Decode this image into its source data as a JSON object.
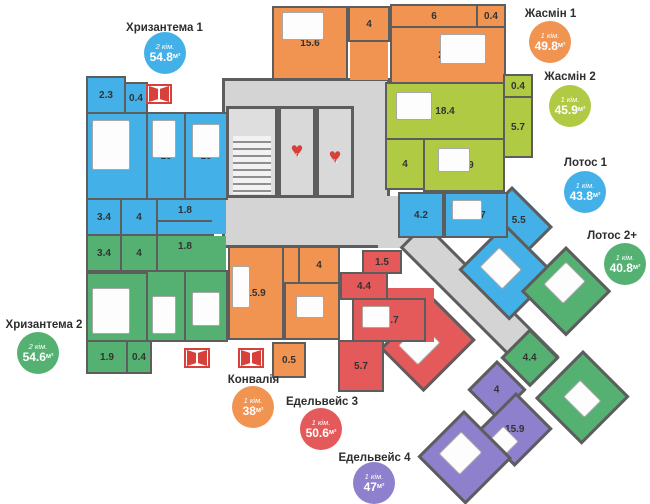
{
  "colors": {
    "blue": "#43b1e8",
    "green": "#54b171",
    "lime": "#b1ca44",
    "orange": "#f19351",
    "red": "#e45a5a",
    "purple": "#8e80cc",
    "wall": "#5d5d5d",
    "common_area": "#d4d4d4",
    "icon_red": "#d8403c"
  },
  "icons": {
    "elevator_heart": "♥",
    "elevator_arrows": "↑↓",
    "window_vent": "open-window"
  },
  "apartments": {
    "chrysanthemum1": {
      "name": "Хризантема 1",
      "rooms_label": "2 кім.",
      "area": "54.8",
      "unit": "м²",
      "areas": {
        "hall": "2.3",
        "balcony": "0.4",
        "bedroom": "14.6",
        "room1": "10",
        "room2": "10",
        "bath1": "3.4",
        "bath2": "4",
        "wc": "1.8"
      }
    },
    "chrysanthemum2": {
      "name": "Хризантема 2",
      "rooms_label": "2 кім.",
      "area": "54.6",
      "unit": "м²",
      "areas": {
        "bath1": "3.4",
        "bath2": "4",
        "wc": "1.8",
        "bedroom": "14.7",
        "room1": "10",
        "room2": "10",
        "hall": "1.9",
        "balcony": "0.4"
      }
    },
    "jasmin1": {
      "name": "Жасмін 1",
      "rooms_label": "1 кім.",
      "area": "49.8",
      "unit": "м²",
      "areas": {
        "kitchen": "15.6",
        "bath": "4",
        "hall": "6",
        "balcony": "0.4",
        "living": "20.4"
      }
    },
    "jasmin2": {
      "name": "Жасмін 2",
      "rooms_label": "1 кім.",
      "area": "45.9",
      "unit": "м²",
      "areas": {
        "living": "18.4",
        "balcony": "0.4",
        "loggia": "5.7",
        "bath": "4",
        "bedroom": "13.9"
      }
    },
    "lotos1": {
      "name": "Лотос 1",
      "rooms_label": "1 кім.",
      "area": "43.8",
      "unit": "м²",
      "areas": {
        "bath": "4.2",
        "kitchen": "12.7",
        "hall": "5.5",
        "living": "16"
      }
    },
    "lotos2": {
      "name": "Лотос 2+",
      "rooms_label": "1 кім.",
      "area": "40.8",
      "unit": "м²",
      "areas": {
        "bedroom": "14.7",
        "bath": "4.4",
        "living": "15.4"
      }
    },
    "konvalia": {
      "name": "Конвалія",
      "rooms_label": "1 кім.",
      "area": "38",
      "unit": "м²",
      "areas": {
        "living": "15.9",
        "bath": "4",
        "kitchen": "13.3",
        "balcony": "0.5"
      }
    },
    "edelweiss3": {
      "name": "Едельвейс 3",
      "rooms_label": "1 кім.",
      "area": "50.6",
      "unit": "м²",
      "areas": {
        "balcony": "1.5",
        "bath": "4.4",
        "kitchen": "13.7",
        "living": "19.6",
        "hall": "5.7"
      }
    },
    "edelweiss4": {
      "name": "Едельвейс 4",
      "rooms_label": "1 кім.",
      "area": "47",
      "unit": "м²",
      "areas": {
        "bath": "4",
        "kitchen": "15.9",
        "living": "18.9"
      }
    }
  }
}
